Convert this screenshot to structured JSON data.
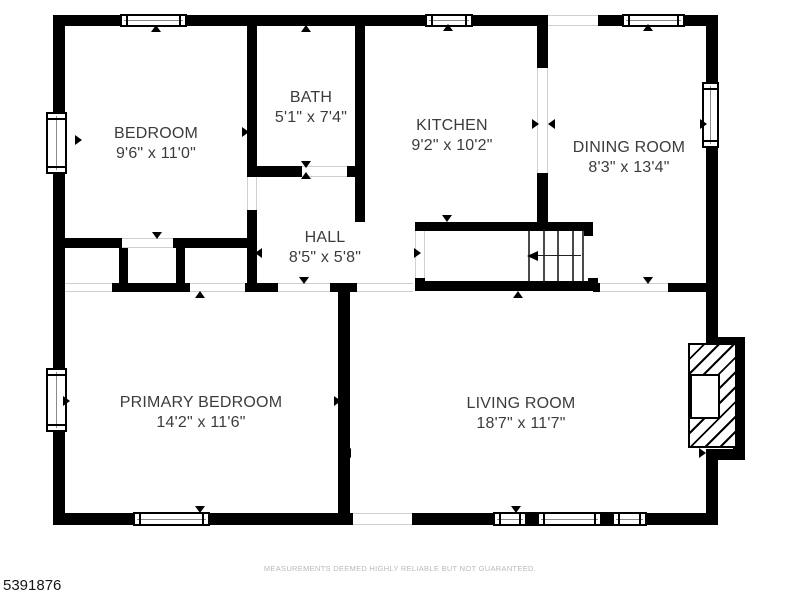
{
  "footer": {
    "disclaimer": "MEASUREMENTS DEEMED HIGHLY RELIABLE BUT NOT GUARANTEED.",
    "plan_number": "5391876"
  },
  "colors": {
    "wall": "#000000",
    "label_text": "#3c3c3c",
    "disclaimer_text": "#b9b9b9",
    "opening_edge": "#cfcfcf",
    "background": "#ffffff"
  },
  "rooms": [
    {
      "id": "bedroom",
      "name": "BEDROOM",
      "dims": "9'6\" x 11'0\"",
      "cx": 156,
      "cy": 144
    },
    {
      "id": "bath",
      "name": "BATH",
      "dims": "5'1\" x 7'4\"",
      "cx": 311,
      "cy": 108
    },
    {
      "id": "kitchen",
      "name": "KITCHEN",
      "dims": "9'2\" x 10'2\"",
      "cx": 452,
      "cy": 136
    },
    {
      "id": "dining-room",
      "name": "DINING ROOM",
      "dims": "8'3\" x 13'4\"",
      "cx": 629,
      "cy": 158
    },
    {
      "id": "hall",
      "name": "HALL",
      "dims": "8'5\" x 5'8\"",
      "cx": 325,
      "cy": 248
    },
    {
      "id": "primary-bedroom",
      "name": "PRIMARY BEDROOM",
      "dims": "14'2\" x 11'6\"",
      "cx": 201,
      "cy": 413
    },
    {
      "id": "living-room",
      "name": "LIVING ROOM",
      "dims": "18'7\" x 11'7\"",
      "cx": 521,
      "cy": 414
    }
  ],
  "plan": {
    "walls": [
      [
        53,
        15,
        67,
        11
      ],
      [
        187,
        15,
        238,
        11
      ],
      [
        473,
        15,
        75,
        11
      ],
      [
        598,
        15,
        24,
        11
      ],
      [
        685,
        15,
        33,
        11
      ],
      [
        53,
        15,
        12,
        97
      ],
      [
        53,
        174,
        12,
        194
      ],
      [
        53,
        432,
        12,
        93
      ],
      [
        53,
        513,
        80,
        12
      ],
      [
        210,
        513,
        143,
        12
      ],
      [
        412,
        513,
        81,
        12
      ],
      [
        647,
        513,
        59,
        12
      ],
      [
        527,
        512,
        10,
        14
      ],
      [
        602,
        512,
        10,
        14
      ],
      [
        706,
        15,
        12,
        67
      ],
      [
        706,
        148,
        12,
        189
      ],
      [
        706,
        460,
        12,
        65
      ],
      [
        706,
        337,
        39,
        11
      ],
      [
        733,
        337,
        12,
        123
      ],
      [
        706,
        449,
        39,
        11
      ],
      [
        247,
        26,
        10,
        151
      ],
      [
        355,
        26,
        10,
        196
      ],
      [
        247,
        166,
        55,
        11
      ],
      [
        347,
        166,
        8,
        11
      ],
      [
        247,
        210,
        10,
        82
      ],
      [
        65,
        238,
        57,
        10
      ],
      [
        173,
        238,
        84,
        10
      ],
      [
        119,
        248,
        9,
        35
      ],
      [
        176,
        248,
        9,
        42
      ],
      [
        112,
        283,
        78,
        9
      ],
      [
        245,
        283,
        33,
        9
      ],
      [
        330,
        283,
        27,
        9
      ],
      [
        338,
        290,
        12,
        223
      ],
      [
        415,
        222,
        178,
        9
      ],
      [
        415,
        222,
        10,
        14
      ],
      [
        583,
        222,
        10,
        14
      ],
      [
        415,
        281,
        183,
        10
      ],
      [
        415,
        278,
        10,
        13
      ],
      [
        588,
        278,
        10,
        13
      ],
      [
        537,
        15,
        11,
        53
      ],
      [
        537,
        173,
        11,
        49
      ],
      [
        593,
        283,
        7,
        9
      ],
      [
        668,
        283,
        38,
        9
      ]
    ],
    "windows": [
      {
        "x": 120,
        "y": 14,
        "w": 67,
        "h": 13,
        "o": "h"
      },
      {
        "x": 425,
        "y": 14,
        "w": 48,
        "h": 13,
        "o": "h"
      },
      {
        "x": 622,
        "y": 14,
        "w": 63,
        "h": 13,
        "o": "h"
      },
      {
        "x": 46,
        "y": 112,
        "w": 21,
        "h": 62,
        "o": "v"
      },
      {
        "x": 46,
        "y": 368,
        "w": 21,
        "h": 64,
        "o": "v"
      },
      {
        "x": 133,
        "y": 512,
        "w": 77,
        "h": 14,
        "o": "h"
      },
      {
        "x": 493,
        "y": 512,
        "w": 34,
        "h": 14,
        "o": "h"
      },
      {
        "x": 537,
        "y": 512,
        "w": 65,
        "h": 14,
        "o": "h"
      },
      {
        "x": 612,
        "y": 512,
        "w": 35,
        "h": 14,
        "o": "h"
      },
      {
        "x": 702,
        "y": 82,
        "w": 17,
        "h": 66,
        "o": "v"
      }
    ],
    "openings": [
      {
        "x": 548,
        "y": 15,
        "w": 50,
        "h": 11,
        "o": "h"
      },
      {
        "x": 353,
        "y": 513,
        "w": 59,
        "h": 12,
        "o": "h"
      },
      {
        "x": 357,
        "y": 283,
        "w": 56,
        "h": 9,
        "o": "h"
      },
      {
        "x": 190,
        "y": 283,
        "w": 55,
        "h": 9,
        "o": "h"
      },
      {
        "x": 278,
        "y": 283,
        "w": 52,
        "h": 9,
        "o": "h"
      },
      {
        "x": 600,
        "y": 283,
        "w": 68,
        "h": 9,
        "o": "h"
      },
      {
        "x": 122,
        "y": 238,
        "w": 51,
        "h": 10,
        "o": "h"
      },
      {
        "x": 65,
        "y": 283,
        "w": 47,
        "h": 9,
        "o": "h"
      },
      {
        "x": 302,
        "y": 166,
        "w": 45,
        "h": 11,
        "o": "h"
      },
      {
        "x": 247,
        "y": 177,
        "w": 10,
        "h": 33,
        "o": "v"
      },
      {
        "x": 537,
        "y": 68,
        "w": 11,
        "h": 105,
        "o": "v"
      },
      {
        "x": 415,
        "y": 231,
        "w": 10,
        "h": 47,
        "o": "v"
      }
    ],
    "arrows": [
      {
        "x": 156,
        "y": 28,
        "d": "up"
      },
      {
        "x": 306,
        "y": 28,
        "d": "up"
      },
      {
        "x": 448,
        "y": 27,
        "d": "up"
      },
      {
        "x": 648,
        "y": 27,
        "d": "up"
      },
      {
        "x": 78,
        "y": 140,
        "d": "right"
      },
      {
        "x": 245,
        "y": 132,
        "d": "right"
      },
      {
        "x": 361,
        "y": 124,
        "d": "left"
      },
      {
        "x": 535,
        "y": 124,
        "d": "right"
      },
      {
        "x": 551,
        "y": 124,
        "d": "left"
      },
      {
        "x": 703,
        "y": 124,
        "d": "right"
      },
      {
        "x": 306,
        "y": 164,
        "d": "down"
      },
      {
        "x": 306,
        "y": 175,
        "d": "up"
      },
      {
        "x": 157,
        "y": 235,
        "d": "down"
      },
      {
        "x": 258,
        "y": 253,
        "d": "left"
      },
      {
        "x": 417,
        "y": 253,
        "d": "right"
      },
      {
        "x": 447,
        "y": 218,
        "d": "down"
      },
      {
        "x": 200,
        "y": 294,
        "d": "up"
      },
      {
        "x": 304,
        "y": 280,
        "d": "down"
      },
      {
        "x": 648,
        "y": 280,
        "d": "down"
      },
      {
        "x": 518,
        "y": 294,
        "d": "up"
      },
      {
        "x": 66,
        "y": 401,
        "d": "right"
      },
      {
        "x": 337,
        "y": 401,
        "d": "right"
      },
      {
        "x": 347,
        "y": 453,
        "d": "left"
      },
      {
        "x": 702,
        "y": 453,
        "d": "right"
      },
      {
        "x": 200,
        "y": 509,
        "d": "down"
      },
      {
        "x": 516,
        "y": 509,
        "d": "down"
      }
    ],
    "stairs": {
      "treads": [
        528,
        543,
        557,
        572,
        582
      ],
      "tread_y1": 231,
      "tread_y2": 281,
      "dir_y": 255,
      "dir_x1": 538,
      "dir_x2": 581,
      "tip_x": 527
    },
    "fireplace": {
      "x": 688,
      "y": 343,
      "w": 49,
      "h": 105,
      "firebox": {
        "x": 690,
        "y": 374,
        "w": 30,
        "h": 45
      }
    }
  }
}
